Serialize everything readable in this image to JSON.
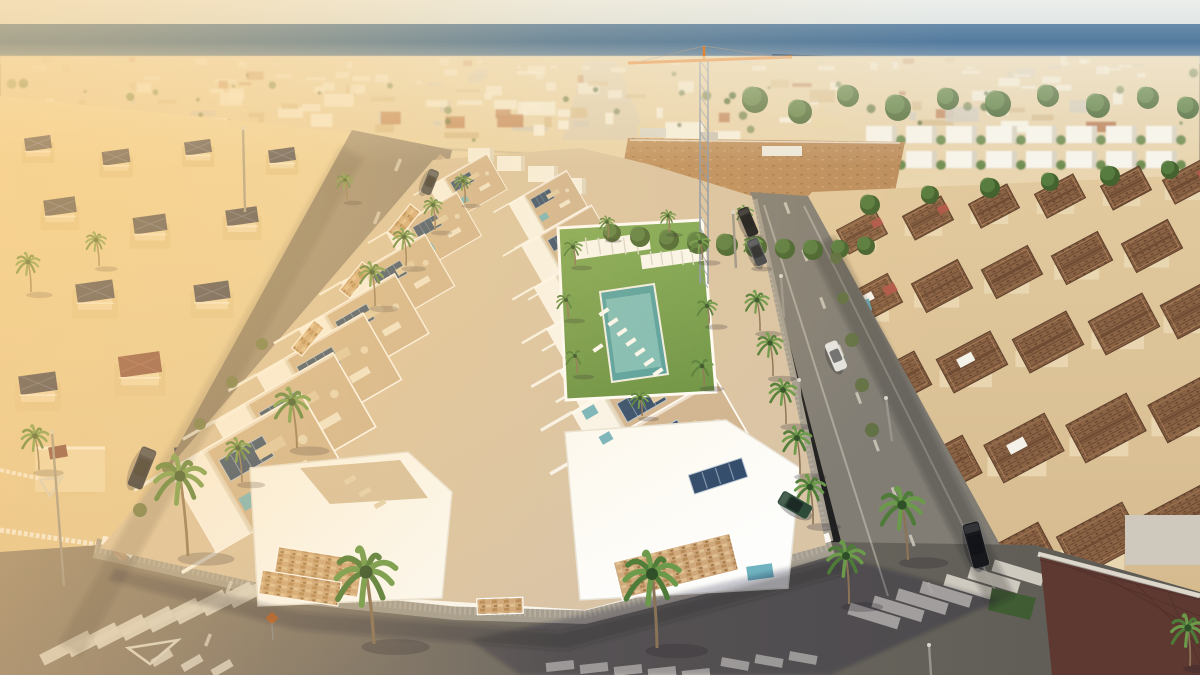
{
  "meta": {
    "description": "Aerial drone view of a new-build white villa development with rooftop solariums, solar panels and a communal lawn with pool, flanked by streets with palm trees and crosswalks, older Mediterranean villas with navy and terracotta roofs on either side, and a coastal town and blue sea on the horizon",
    "width": 1200,
    "height": 675
  },
  "palette": {
    "sky_top": "#eceeeb",
    "sky_bot": "#e0e6e5",
    "sea_top": "#6a8cab",
    "sea_mid": "#537b9f",
    "sea_bot": "#93a9bd",
    "city_a": "#ead7b2",
    "city_b": "#e3cfa8",
    "bld_white": "#f6f2e6",
    "bld_cream": "#e6d2a8",
    "bld_tan": "#d4b98c",
    "bld_terra": "#b97c55",
    "bld_grey": "#cfc8bb",
    "green_tree": "#44632f",
    "green_tree2": "#5d8243",
    "bush": "#5e7040",
    "cream_l1": "#eed9ad",
    "cream_l2": "#e3c898",
    "navy_roof": "#2e3450",
    "navy_ridge": "#565e84",
    "maroon_roof": "#7c4140",
    "cream_r1": "#e2c99e",
    "cream_r2": "#d3b88c",
    "tile_base": "#8a6244",
    "tile_dark": "#6f4c34",
    "tile_light": "#c49a6a",
    "red_gable": "#b0584a",
    "dirt": "#bb8d5e",
    "road_warm1": "#8d8072",
    "road_warm2": "#7a7164",
    "road_cool": "#817d75",
    "road_dark": "#5c5a54",
    "sidewalk": "#a49d90",
    "sidewalk_in": "#b3ac9e",
    "sidewalk_pink": "#bca188",
    "sidewalk_pink_in": "#ccb298",
    "wall_white": "#faf8f2",
    "dev_base": "#d9c4a6",
    "dev_terrace": "#cfb493",
    "dev_white": "#f9f7f1",
    "solar": "#2c486b",
    "solar_line": "#9fb4cc",
    "teal": "#6fb3c0",
    "lawn1": "#7aa854",
    "lawn2": "#648f41",
    "pool": "#4f9fa2",
    "pool_light": "#83c3c0",
    "marking": "#d8d4c8",
    "orange_sign": "#d86820",
    "crane_mast": "#8795aa",
    "crane_jib": "#e07a26",
    "palm_trunk": "#8a7356",
    "palm_green": "#4e7c38",
    "palm_green2": "#6a9a4a",
    "car_dark": "#1c2436",
    "car_black": "#17181c",
    "car_white": "#e2e2df",
    "car_green": "#2e4a38",
    "car_grey": "#3a3f48",
    "shadow": "rgba(35,32,45,0.28)"
  },
  "city": {
    "seed": 7,
    "count": 175,
    "trees": 48,
    "townhouse_rows": [
      126,
      151
    ],
    "townhouse_x0": 866,
    "townhouse_x1": 1185,
    "townhouse_step": 40
  },
  "sea": {
    "jetty": [
      772,
      55,
      868,
      58
    ]
  },
  "powerline": [
    96,
    131,
    540,
    154,
    700,
    168
  ],
  "crane": {
    "mx": 704,
    "top": 60,
    "bot": 284,
    "jib_l": 628,
    "jib_r": 792,
    "jy": 60
  },
  "left_villas": [
    [
      38,
      148,
      0.6,
      0
    ],
    [
      116,
      162,
      0.62,
      0
    ],
    [
      198,
      152,
      0.6,
      0
    ],
    [
      282,
      160,
      0.6,
      0
    ],
    [
      352,
      168,
      0.55,
      0
    ],
    [
      60,
      212,
      0.72,
      0
    ],
    [
      150,
      230,
      0.75,
      0
    ],
    [
      242,
      222,
      0.72,
      0
    ],
    [
      330,
      212,
      0.66,
      0
    ],
    [
      95,
      298,
      0.85,
      0
    ],
    [
      212,
      298,
      0.8,
      0
    ],
    [
      303,
      286,
      0.72,
      0
    ],
    [
      140,
      372,
      0.95,
      1
    ],
    [
      38,
      390,
      0.85,
      0
    ],
    [
      255,
      368,
      0.8,
      0
    ],
    [
      70,
      470,
      1.0,
      2
    ],
    [
      195,
      462,
      0.9,
      0
    ]
  ],
  "right_villas": [
    [
      862,
      232,
      0.75,
      1,
      0
    ],
    [
      928,
      218,
      0.75,
      1,
      0
    ],
    [
      994,
      206,
      0.75,
      0,
      0
    ],
    [
      1060,
      196,
      0.75,
      0,
      0
    ],
    [
      1126,
      188,
      0.75,
      0,
      0
    ],
    [
      1188,
      182,
      0.75,
      1,
      0
    ],
    [
      872,
      300,
      0.9,
      1,
      1
    ],
    [
      942,
      286,
      0.9,
      0,
      0
    ],
    [
      1012,
      272,
      0.9,
      0,
      0
    ],
    [
      1082,
      258,
      0.9,
      0,
      0
    ],
    [
      1152,
      246,
      0.9,
      0,
      0
    ],
    [
      896,
      382,
      1.05,
      0,
      0
    ],
    [
      972,
      362,
      1.05,
      0,
      1
    ],
    [
      1048,
      342,
      1.05,
      0,
      0
    ],
    [
      1124,
      324,
      1.05,
      0,
      0
    ],
    [
      1196,
      308,
      1.05,
      0,
      0
    ],
    [
      942,
      470,
      1.18,
      0,
      0
    ],
    [
      1024,
      448,
      1.18,
      0,
      1
    ],
    [
      1106,
      428,
      1.18,
      0,
      0
    ],
    [
      1188,
      408,
      1.18,
      0,
      0
    ],
    [
      1016,
      560,
      1.28,
      0,
      0
    ],
    [
      1100,
      540,
      1.28,
      0,
      0
    ],
    [
      1184,
      520,
      1.28,
      0,
      0
    ]
  ],
  "right_pools": [
    [
      858,
      308,
      26,
      12,
      -16
    ],
    [
      864,
      344,
      20,
      10,
      -16
    ]
  ],
  "dev": {
    "base": [
      [
        433,
        160
      ],
      [
        580,
        148
      ],
      [
        648,
        164
      ],
      [
        752,
        196
      ],
      [
        826,
        545
      ],
      [
        698,
        580
      ],
      [
        585,
        610
      ],
      [
        300,
        592
      ],
      [
        100,
        548
      ]
    ],
    "left_row": [
      [
        468,
        188,
        0.52
      ],
      [
        434,
        234,
        0.63
      ],
      [
        398,
        284,
        0.75
      ],
      [
        364,
        331,
        0.86
      ],
      [
        329,
        377,
        0.96
      ],
      [
        295,
        424,
        1.07
      ],
      [
        259,
        473,
        1.19
      ]
    ],
    "right_row": [
      [
        548,
        205,
        0.52
      ],
      [
        569,
        247,
        0.63
      ],
      [
        590,
        289,
        0.74
      ],
      [
        611,
        331,
        0.85
      ],
      [
        632,
        373,
        0.96
      ],
      [
        653,
        415,
        1.07
      ],
      [
        674,
        457,
        1.18
      ]
    ],
    "far_blocks": [
      [
        468,
        148,
        26,
        14
      ],
      [
        497,
        156,
        28,
        15
      ],
      [
        528,
        166,
        30,
        16
      ],
      [
        556,
        178,
        30,
        16
      ]
    ],
    "garden": {
      "lawn": [
        [
          558,
          228
        ],
        [
          702,
          220
        ],
        [
          716,
          392
        ],
        [
          566,
          400
        ]
      ],
      "pool": [
        [
          600,
          292
        ],
        [
          654,
          284
        ],
        [
          668,
          374
        ],
        [
          612,
          382
        ]
      ],
      "pergolas": [
        [
          612,
          246,
          76,
          17,
          -8
        ],
        [
          672,
          258,
          62,
          14,
          -8
        ]
      ],
      "loungers": [
        [
          604,
          312
        ],
        [
          613,
          322
        ],
        [
          622,
          332
        ],
        [
          631,
          342
        ],
        [
          640,
          352
        ],
        [
          649,
          362
        ],
        [
          658,
          372
        ],
        [
          598,
          348
        ]
      ]
    },
    "fl_poly": [
      [
        250,
        468
      ],
      [
        408,
        452
      ],
      [
        452,
        492
      ],
      [
        442,
        598
      ],
      [
        258,
        606
      ]
    ],
    "fl_terrace": [
      [
        300,
        468
      ],
      [
        400,
        460
      ],
      [
        428,
        498
      ],
      [
        330,
        504
      ]
    ],
    "fl_loungers": [
      [
        350,
        480
      ],
      [
        365,
        492
      ],
      [
        380,
        504
      ]
    ],
    "fl_stone": [
      318,
      572,
      86,
      38,
      9
    ],
    "fr_poly": [
      [
        565,
        432
      ],
      [
        726,
        420
      ],
      [
        800,
        468
      ],
      [
        788,
        588
      ],
      [
        580,
        600
      ]
    ],
    "fr_solar": [
      718,
      476,
      56,
      20,
      -18
    ],
    "fr_stone": [
      676,
      566,
      120,
      38,
      -14
    ],
    "fr_pool": [
      760,
      572,
      26,
      14,
      -8
    ],
    "teal_bits": [
      [
        590,
        412,
        14,
        10,
        -30
      ],
      [
        606,
        438,
        12,
        9,
        -30
      ]
    ],
    "wall_stones": [
      [
        404,
        222,
        36,
        13,
        -51
      ],
      [
        356,
        280,
        36,
        13,
        -51
      ],
      [
        308,
        338,
        36,
        13,
        -51
      ],
      [
        300,
        588,
        80,
        24,
        9
      ],
      [
        500,
        606,
        46,
        16,
        -2
      ]
    ]
  },
  "roads": {
    "left": [
      [
        352,
        130
      ],
      [
        452,
        150
      ],
      [
        340,
        675
      ],
      [
        52,
        675
      ]
    ],
    "right": [
      [
        750,
        192
      ],
      [
        808,
        196
      ],
      [
        1035,
        608
      ],
      [
        872,
        660
      ]
    ],
    "bottom": [
      [
        0,
        552
      ],
      [
        100,
        545
      ],
      [
        300,
        592
      ],
      [
        455,
        608
      ],
      [
        585,
        612
      ],
      [
        698,
        582
      ],
      [
        830,
        542
      ],
      [
        1035,
        545
      ],
      [
        1200,
        592
      ],
      [
        1200,
        675
      ],
      [
        0,
        675
      ]
    ],
    "sidewalk_bottom": [
      [
        95,
        548
      ],
      [
        300,
        594
      ],
      [
        455,
        610
      ],
      [
        585,
        614
      ],
      [
        700,
        585
      ],
      [
        832,
        545
      ]
    ],
    "sidewalk_left": [
      [
        445,
        158
      ],
      [
        118,
        558
      ]
    ],
    "sidewalk_right": [
      [
        752,
        200
      ],
      [
        828,
        542
      ]
    ],
    "wall_bottom": [
      [
        102,
        540
      ],
      [
        300,
        586
      ],
      [
        455,
        602
      ],
      [
        585,
        606
      ],
      [
        700,
        577
      ],
      [
        830,
        537
      ]
    ],
    "wall_left": [
      [
        452,
        162
      ],
      [
        128,
        556
      ]
    ],
    "wall_right": [
      [
        747,
        204
      ],
      [
        820,
        540
      ]
    ],
    "dash_left": [
      398,
      165,
      208,
      640,
      10
    ],
    "dash_right": [
      787,
      208,
      930,
      588,
      9
    ],
    "edge_right_a": [
      764,
      205,
      888,
      596
    ],
    "edge_right_b": [
      804,
      206,
      1000,
      600
    ]
  },
  "crosswalks": [
    {
      "x": 66,
      "y": 648,
      "sx": 27,
      "sy": -8.2,
      "n": 8,
      "len": 54,
      "wid": 12,
      "rot": -27
    },
    {
      "x": 874,
      "y": 616,
      "sx": 24,
      "sy": -7.2,
      "n": 7,
      "len": 52,
      "wid": 12,
      "rot": 17
    }
  ],
  "stopbars": [
    {
      "x": 162,
      "y": 658,
      "sx": 30,
      "sy": 5,
      "n": 3,
      "len": 22,
      "wid": 8,
      "rot": -30
    },
    {
      "x": 560,
      "y": 666,
      "sx": 34,
      "sy": 2,
      "n": 5,
      "len": 28,
      "wid": 9,
      "rot": -6
    },
    {
      "x": 735,
      "y": 664,
      "sx": 34,
      "sy": -3,
      "n": 3,
      "len": 28,
      "wid": 9,
      "rot": 10
    }
  ],
  "yield_triangles": [
    [
      [
        128,
        648
      ],
      [
        178,
        640
      ],
      [
        150,
        664
      ]
    ],
    [
      [
        40,
        480
      ],
      [
        62,
        477
      ],
      [
        50,
        496
      ]
    ]
  ],
  "orange_sign": [
    272,
    618
  ],
  "palms": [
    [
      366,
      572,
      36,
      374,
      644
    ],
    [
      652,
      574,
      33,
      657,
      648
    ],
    [
      846,
      556,
      22,
      849,
      604
    ],
    [
      180,
      476,
      30,
      188,
      556
    ],
    [
      292,
      402,
      21,
      297,
      448
    ],
    [
      238,
      448,
      15,
      242,
      482
    ],
    [
      372,
      272,
      15,
      375,
      306
    ],
    [
      404,
      237,
      13,
      406,
      266
    ],
    [
      433,
      205,
      11,
      435,
      230
    ],
    [
      463,
      181,
      10,
      465,
      203
    ],
    [
      757,
      300,
      14,
      760,
      331
    ],
    [
      770,
      343,
      15,
      773,
      376
    ],
    [
      783,
      390,
      16,
      786,
      424
    ],
    [
      797,
      438,
      17,
      800,
      474
    ],
    [
      810,
      487,
      18,
      813,
      524
    ],
    [
      745,
      212,
      10,
      747,
      233
    ],
    [
      753,
      243,
      11,
      755,
      266
    ],
    [
      573,
      247,
      11,
      575,
      265
    ],
    [
      700,
      242,
      12,
      702,
      260
    ],
    [
      566,
      300,
      11,
      568,
      318
    ],
    [
      707,
      306,
      12,
      709,
      324
    ],
    [
      575,
      356,
      11,
      577,
      374
    ],
    [
      702,
      366,
      13,
      704,
      386
    ],
    [
      640,
      398,
      11,
      642,
      416
    ],
    [
      607,
      222,
      9,
      608,
      238
    ],
    [
      668,
      216,
      9,
      669,
      232
    ],
    [
      28,
      262,
      14,
      31,
      292
    ],
    [
      96,
      240,
      12,
      99,
      266
    ],
    [
      345,
      180,
      10,
      347,
      200
    ],
    [
      35,
      436,
      16,
      39,
      470
    ],
    [
      902,
      505,
      26,
      908,
      560
    ],
    [
      1188,
      628,
      20,
      1190,
      666
    ]
  ],
  "trees": [
    [
      755,
      100,
      13
    ],
    [
      800,
      112,
      12
    ],
    [
      848,
      96,
      11
    ],
    [
      898,
      108,
      13
    ],
    [
      948,
      99,
      11
    ],
    [
      998,
      104,
      13
    ],
    [
      1048,
      96,
      11
    ],
    [
      1098,
      106,
      12
    ],
    [
      1148,
      98,
      11
    ],
    [
      1188,
      108,
      11
    ],
    [
      870,
      205,
      10
    ],
    [
      930,
      195,
      9
    ],
    [
      990,
      188,
      10
    ],
    [
      1050,
      182,
      9
    ],
    [
      1110,
      176,
      10
    ],
    [
      1170,
      170,
      9
    ],
    [
      612,
      233,
      9
    ],
    [
      640,
      237,
      10
    ],
    [
      669,
      240,
      10
    ],
    [
      698,
      243,
      11
    ],
    [
      727,
      245,
      11
    ],
    [
      756,
      247,
      11
    ],
    [
      785,
      249,
      10
    ],
    [
      813,
      250,
      10
    ],
    [
      840,
      249,
      9
    ],
    [
      866,
      246,
      9
    ]
  ],
  "bushes": [
    [
      836,
      258,
      6
    ],
    [
      843,
      298,
      6
    ],
    [
      852,
      340,
      7
    ],
    [
      862,
      385,
      7
    ],
    [
      872,
      430,
      7
    ],
    [
      140,
      510,
      7
    ],
    [
      168,
      468,
      6
    ],
    [
      200,
      424,
      6
    ],
    [
      232,
      382,
      6
    ],
    [
      262,
      344,
      6
    ]
  ],
  "cars": [
    [
      142,
      468,
      112,
      42,
      16,
      "car_dark"
    ],
    [
      430,
      182,
      112,
      26,
      11,
      "car_grey"
    ],
    [
      748,
      222,
      67,
      30,
      12,
      "car_black"
    ],
    [
      757,
      252,
      67,
      28,
      12,
      "car_grey"
    ],
    [
      836,
      356,
      67,
      30,
      13,
      "car_white"
    ],
    [
      976,
      545,
      75,
      46,
      17,
      "car_black"
    ],
    [
      795,
      505,
      30,
      34,
      15,
      "car_green"
    ]
  ],
  "lights": [
    [
      52,
      432,
      64,
      586
    ],
    [
      243,
      128,
      245,
      212
    ],
    [
      733,
      212,
      736,
      268
    ],
    [
      781,
      276,
      784,
      318
    ],
    [
      799,
      380,
      802,
      419
    ],
    [
      886,
      398,
      892,
      441
    ],
    [
      929,
      645,
      931,
      675
    ]
  ],
  "corner_property": {
    "tiles": [
      [
        1040,
        556
      ],
      [
        1200,
        598
      ],
      [
        1200,
        675
      ],
      [
        1052,
        675
      ]
    ],
    "wall": [
      1038,
      554,
      1200,
      596
    ],
    "green": [
      [
        992,
        588
      ],
      [
        1036,
        598
      ],
      [
        1030,
        620
      ],
      [
        988,
        610
      ]
    ],
    "building": [
      1125,
      515,
      110,
      50
    ]
  }
}
